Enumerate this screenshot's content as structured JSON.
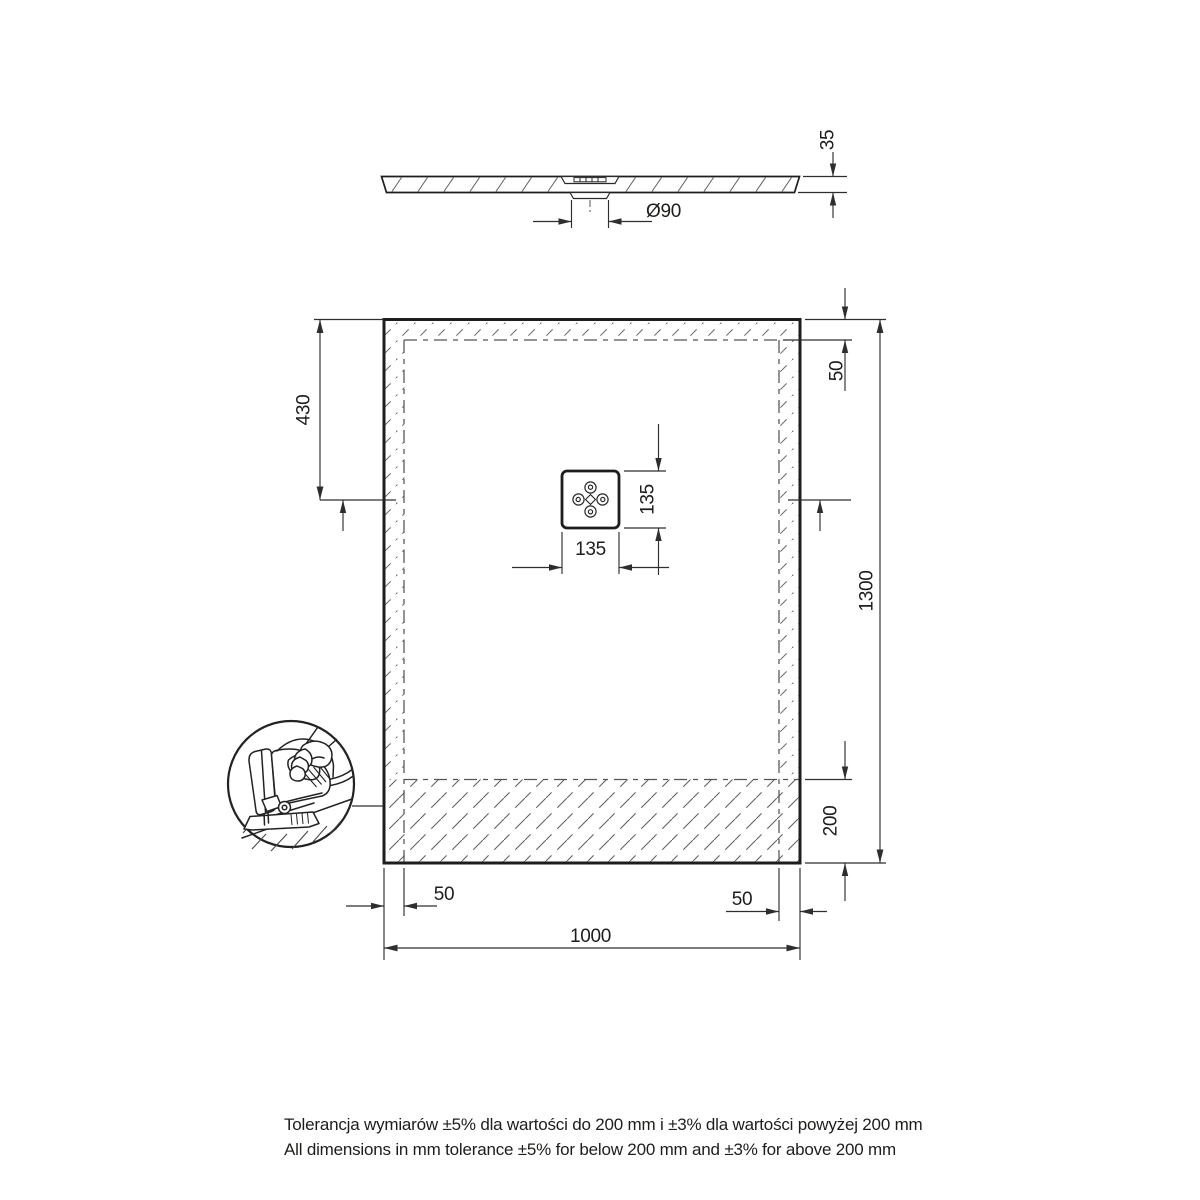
{
  "drawing": {
    "background": "#ffffff",
    "ink": "#1d1d1b"
  },
  "section_view": {
    "thickness": "35",
    "drain_diameter": "Ø90"
  },
  "plan_view": {
    "overall_width": "1000",
    "overall_height": "1300",
    "drain_offset_from_top": "430",
    "trim_margin_top": "50",
    "trim_margin_left": "50",
    "trim_margin_right": "50",
    "trim_zone_bottom": "200",
    "drain_cover_width": "135",
    "drain_cover_height": "135"
  },
  "notes": {
    "tolerance_pl": "Tolerancja wymiarów ±5% dla wartości do 200 mm i ±3% dla wartości powyżej 200 mm",
    "tolerance_en": "All dimensions in mm tolerance ±5% for below 200 mm and ±3% for above 200 mm"
  }
}
